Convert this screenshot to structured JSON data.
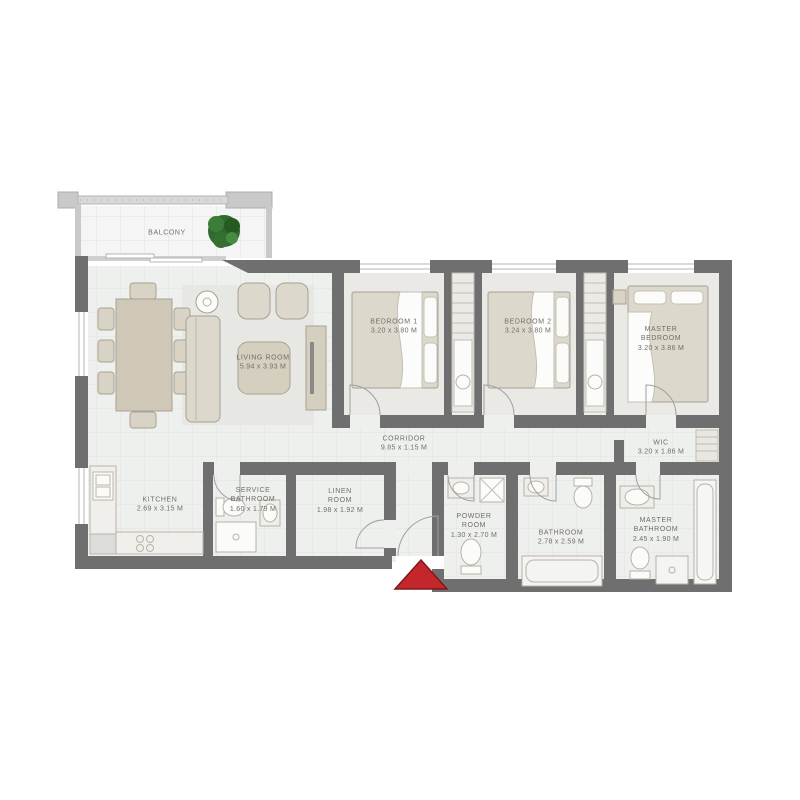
{
  "plan": {
    "type": "apartment-floor-plan",
    "rooms": {
      "balcony": {
        "name": "BALCONY",
        "dims": ""
      },
      "living_room": {
        "name": "LIVING ROOM",
        "dims": "5.94 x 3.93 M"
      },
      "bedroom_1": {
        "name": "BEDROOM 1",
        "dims": "3.20 x 3.80 M"
      },
      "bedroom_2": {
        "name": "BEDROOM 2",
        "dims": "3.24 x 3.80 M"
      },
      "master_bedroom": {
        "name": "MASTER BEDROOM",
        "dims": "3.20 x 3.86 M"
      },
      "corridor": {
        "name": "CORRIDOR",
        "dims": "9.85 x 1.15 M"
      },
      "wic": {
        "name": "WIC",
        "dims": "3.20 x 1.86 M"
      },
      "kitchen": {
        "name": "KITCHEN",
        "dims": "2.69 x 3.15 M"
      },
      "service_bathroom": {
        "name": "SERVICE BATHROOM",
        "dims": "1.60 x 1.79 M"
      },
      "linen_room": {
        "name": "LINEN ROOM",
        "dims": "1.98 x 1.92 M"
      },
      "powder_room": {
        "name": "POWDER ROOM",
        "dims": "1.30 x 2.70 M"
      },
      "bathroom": {
        "name": "BATHROOM",
        "dims": "2.78 x 2.59 M"
      },
      "master_bathroom": {
        "name": "MASTER BATHROOM",
        "dims": "2.45 x 1.90 M"
      }
    },
    "colors": {
      "wall": "#6f6f6f",
      "light_wall": "#cccccc",
      "floor": "#eef0ee",
      "grid": "#e0e2e0",
      "furniture": "#d9d3c6",
      "furniture_stroke": "#a8a194",
      "fixture_white": "#fbfbfa",
      "plant_green": "#2e6b2e",
      "entrance_arrow_red": "#c4262b",
      "label_text": "#6f6e6a"
    },
    "icons": {
      "plant": "balcony plant",
      "entrance_arrow": "entrance direction marker"
    }
  }
}
